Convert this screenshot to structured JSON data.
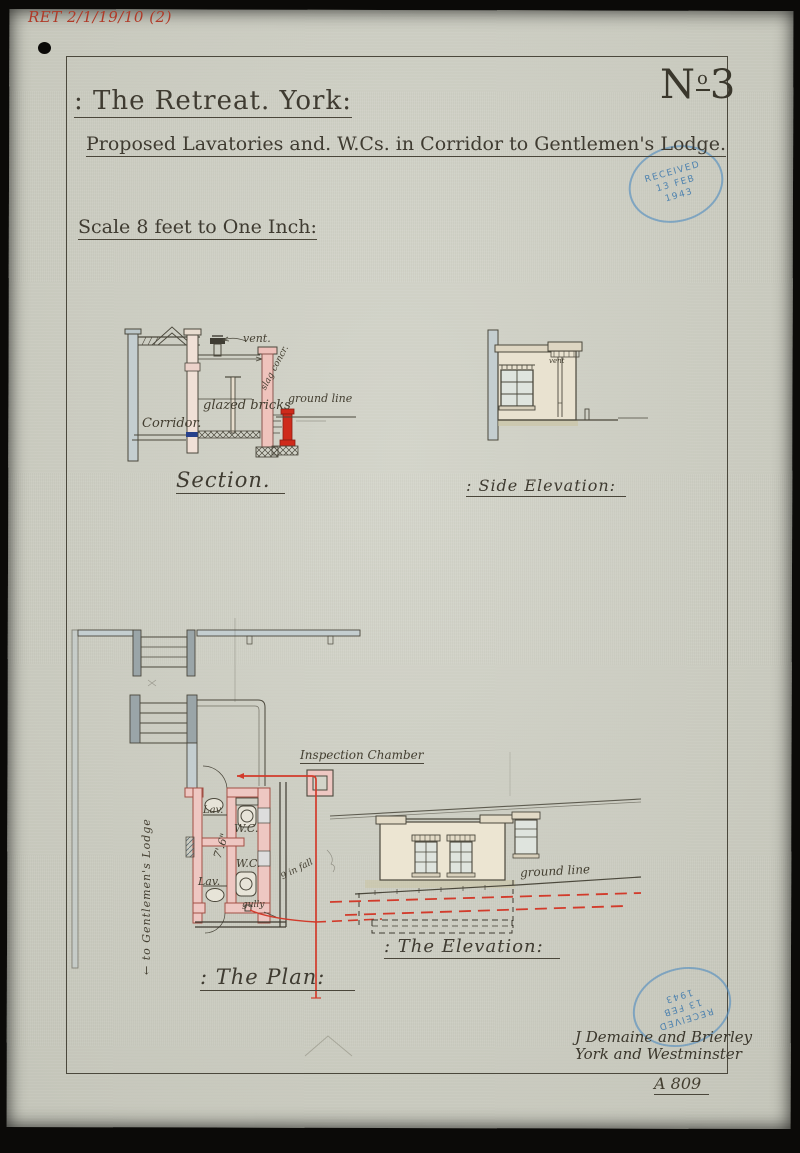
{
  "page": {
    "archive_ref": "RET 2/1/19/10 (2)",
    "sheet_number_prefix": "N",
    "sheet_number_sup": "o",
    "sheet_number_digit": "3",
    "title": ": The Retreat. York:",
    "subtitle": "Proposed Lavatories and. W.Cs. in Corridor to Gentlemen's Lodge.",
    "scale_note": "Scale 8 feet to One Inch:",
    "folio": "A 809"
  },
  "stamps": {
    "received_top": {
      "line1": "Received",
      "line2": "13 FEB",
      "line3": "1943"
    },
    "received_bottom": {
      "line1": "Received",
      "line2": "13 FEB",
      "line3": "1943"
    }
  },
  "section": {
    "caption": "Section.",
    "labels": {
      "vent": "vent.",
      "glazed_bricks": "glazed bricks",
      "corridor": "Corridor.",
      "slag_concrete": "slag concr.",
      "ground_line": "ground line"
    }
  },
  "side_elevation": {
    "caption": ": Side Elevation:",
    "labels": {
      "vent": "vent"
    }
  },
  "plan": {
    "caption": ": The Plan:",
    "labels": {
      "inspection_chamber": "Inspection Chamber",
      "lav_top": "Lav.",
      "wc_top": "W.C.",
      "dimension": "7'.6\"",
      "wc_bottom": "W.C.",
      "lav_bottom": "Lav.",
      "gully": "gully",
      "fall": "9 in fall",
      "to_lodge": "← to Gentlemen's Lodge"
    }
  },
  "elevation": {
    "caption": ": The Elevation:",
    "labels": {
      "ground_line": "ground line"
    }
  },
  "signature": {
    "line1": "J Demaine and Brierley",
    "line2": "York and Westminster"
  },
  "colors": {
    "ink": "#3f3b31",
    "red_ink": "#b03a28",
    "pipe_red": "#cf2a1b",
    "wall_pink": "#eec7c2",
    "wall_bluegray": "#bcc7c9",
    "stamp_blue": "#5b94c3"
  }
}
